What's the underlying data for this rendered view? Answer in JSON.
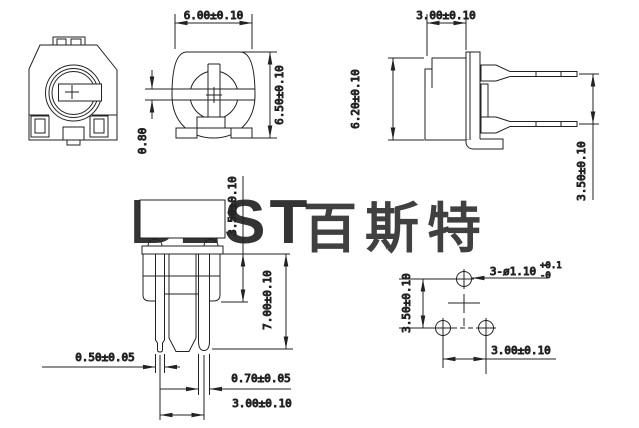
{
  "drawing": {
    "watermark": {
      "latin": "BEST",
      "cjk": "百斯特"
    },
    "front_view": {
      "width": "6.00±0.10",
      "height": "6.50±0.10",
      "slot_width": "0.80"
    },
    "side_view": {
      "depth": "3.00±0.10",
      "height": "6.20±0.10",
      "pin_spacing": "3.50±0.10"
    },
    "bottom_view": {
      "shoulder_height": "3.50±0.10",
      "pin_length": "7.00±0.10",
      "pin_width_small": "0.50±0.05",
      "pin_width_large": "0.70±0.05",
      "pin_pitch": "3.00±0.10"
    },
    "hole_view": {
      "vertical_pitch": "3.50±0.10",
      "horizontal_pitch": "3.00±0.10",
      "hole_note": "3-ø1.10",
      "hole_tol_plus": "+0.1",
      "hole_tol_minus": "-0"
    }
  },
  "colors": {
    "line": "#222222",
    "watermark": "#b5d9ef",
    "background": "#ffffff"
  }
}
